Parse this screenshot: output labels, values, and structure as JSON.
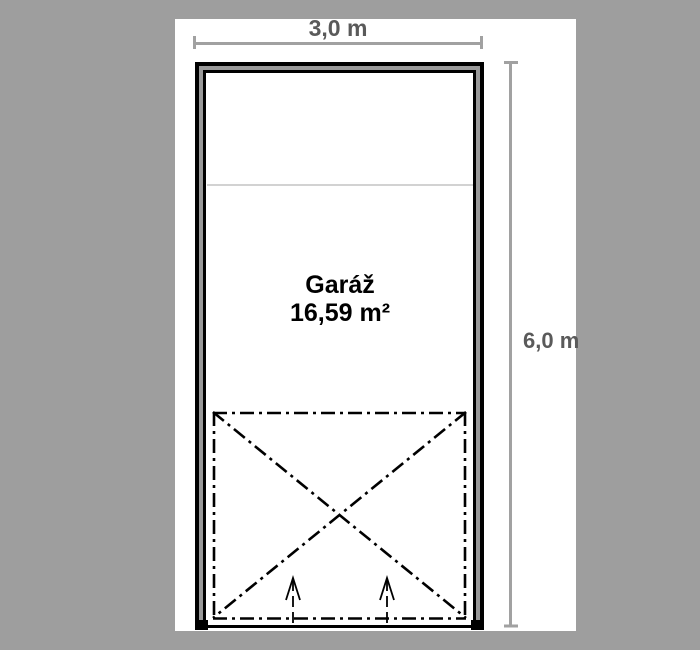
{
  "floor_plan": {
    "room": {
      "label": "Garáž",
      "area": "16,59 m²"
    },
    "dimensions": {
      "width": {
        "label": "3,0 m"
      },
      "height": {
        "label": "6,0 m"
      }
    },
    "icons": {
      "entry_arrow": "up-open-arrow",
      "door_zone": "dash-dot-x-swing-zone"
    },
    "colors": {
      "background": "#9e9e9e",
      "paper": "#ffffff",
      "wall_line": "#000000",
      "wall_fill": "#999999",
      "dimension_line": "#a1a1a1",
      "dimension_text": "#5a5a5a",
      "drawing_line": "#000000",
      "faint_line": "#c4c4c4"
    }
  }
}
